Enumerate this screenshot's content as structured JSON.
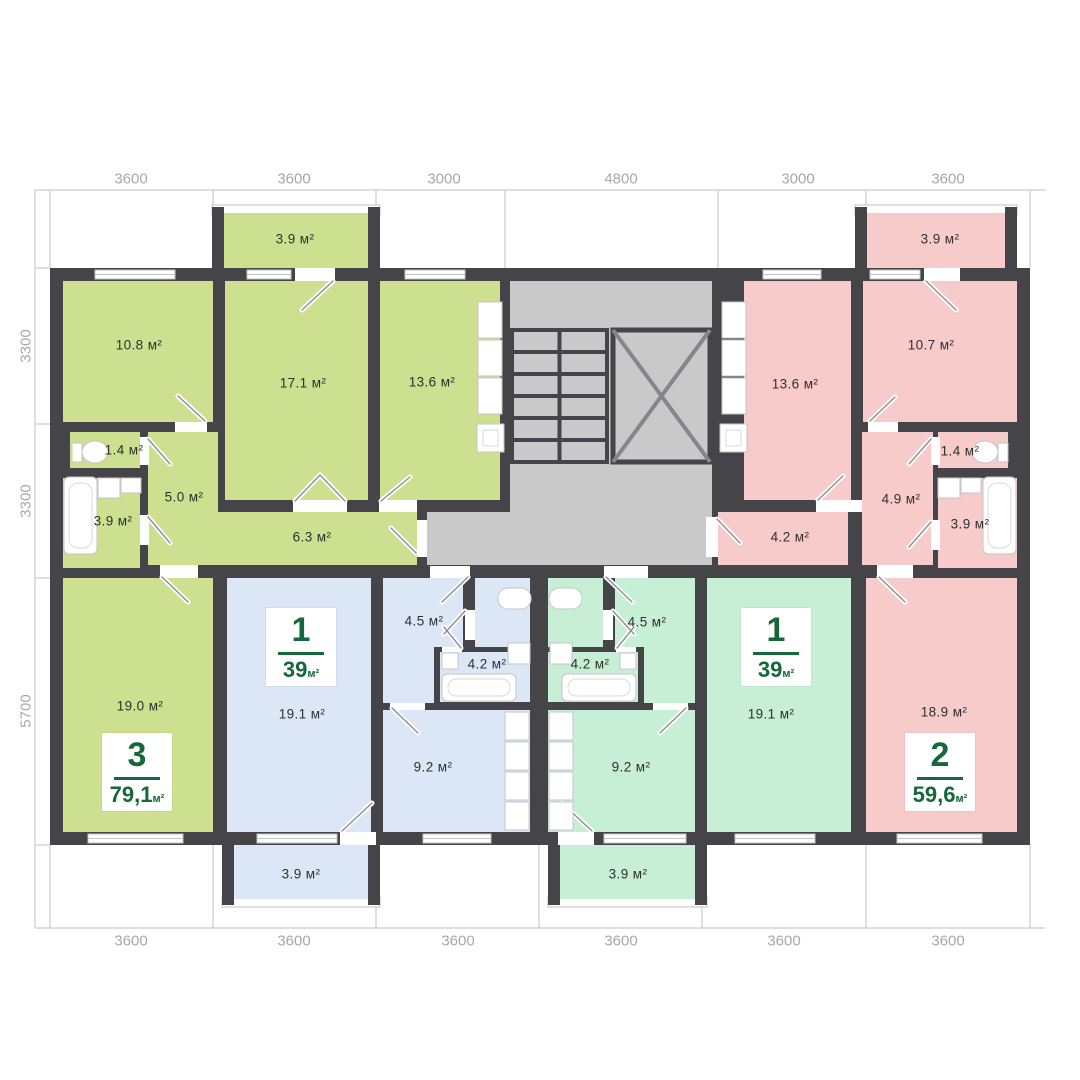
{
  "plan_title": "Typical floor plan with four apartments around a central stair-elevator core",
  "dimensions": {
    "top": [
      "3600",
      "3600",
      "3000",
      "4800",
      "3000",
      "3600"
    ],
    "left": [
      "3300",
      "3300",
      "5700"
    ],
    "bottom": [
      "3600",
      "3600",
      "3600",
      "3600",
      "3600",
      "3600"
    ]
  },
  "rooms": {
    "g_balcony": "3.9 м²",
    "g_10_8": "10.8 м²",
    "g_17_1": "17.1 м²",
    "g_13_6": "13.6 м²",
    "g_1_4": "1.4 м²",
    "g_5_0": "5.0 м²",
    "g_3_9": "3.9 м²",
    "g_6_3": "6.3 м²",
    "g_19_0": "19.0 м²",
    "b_19_1": "19.1 м²",
    "b_4_5": "4.5 м²",
    "b_4_2": "4.2 м²",
    "b_9_2": "9.2 м²",
    "b_balcony": "3.9 м²",
    "m_4_5": "4.5 м²",
    "m_4_2": "4.2 м²",
    "m_9_2": "9.2 м²",
    "m_19_1": "19.1 м²",
    "m_balcony": "3.9 м²",
    "p_13_6": "13.6 м²",
    "p_10_7": "10.7 м²",
    "p_1_4": "1.4 м²",
    "p_4_9": "4.9 м²",
    "p_3_9": "3.9 м²",
    "p_4_2": "4.2 м²",
    "p_18_9": "18.9 м²",
    "p_balcony": "3.9 м²"
  },
  "apartments": {
    "apt3": {
      "number": "3",
      "area": "79,1",
      "unit": "м²"
    },
    "apt1b": {
      "number": "1",
      "area": "39",
      "unit": "м²"
    },
    "apt1m": {
      "number": "1",
      "area": "39",
      "unit": "м²"
    },
    "apt2": {
      "number": "2",
      "area": "59,6",
      "unit": "м²"
    }
  },
  "colors": {
    "wall": "#454549",
    "green": "#cde08f",
    "blue": "#dbe7f7",
    "mint": "#c7efd5",
    "pink": "#f6cbc9",
    "core": "#c9c9ca",
    "badge-green": "#15683a",
    "dim-text": "#a8a8a8",
    "label-text": "#303030"
  }
}
